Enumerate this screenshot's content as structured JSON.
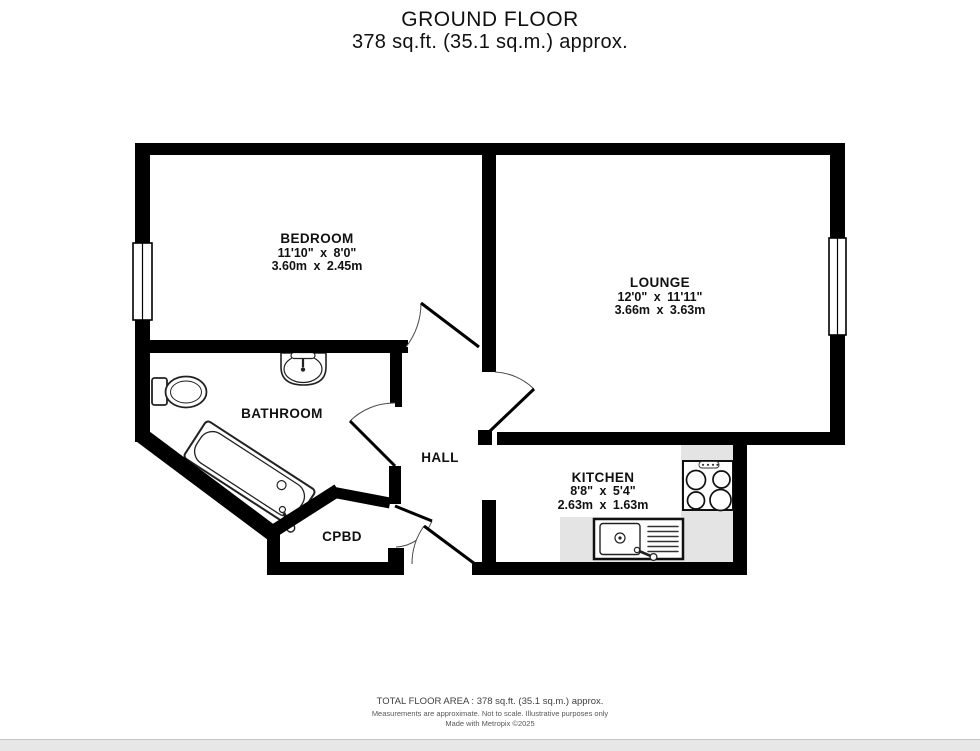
{
  "header": {
    "title": "GROUND FLOOR",
    "subtitle": "378 sq.ft. (35.1 sq.m.) approx."
  },
  "rooms": {
    "bedroom": {
      "name": "BEDROOM",
      "imperial": "11'10\" x 8'0\"",
      "metric": "3.60m x 2.45m"
    },
    "lounge": {
      "name": "LOUNGE",
      "imperial": "12'0\" x 11'11\"",
      "metric": "3.66m x 3.63m"
    },
    "kitchen": {
      "name": "KITCHEN",
      "imperial": "8'8\" x 5'4\"",
      "metric": "2.63m x 1.63m"
    },
    "bathroom": {
      "name": "BATHROOM"
    },
    "hall": {
      "name": "HALL"
    },
    "cupboard": {
      "name": "CPBD"
    }
  },
  "footer": {
    "total_area": "TOTAL FLOOR AREA : 378 sq.ft. (35.1 sq.m.) approx.",
    "disclaimer": "Measurements are approximate.  Not to scale.  Illustrative purposes only",
    "credit": "Made with Metropix ©2025"
  },
  "colors": {
    "wall": "#000000",
    "counter": "#e4e4e4",
    "background": "#ffffff"
  }
}
